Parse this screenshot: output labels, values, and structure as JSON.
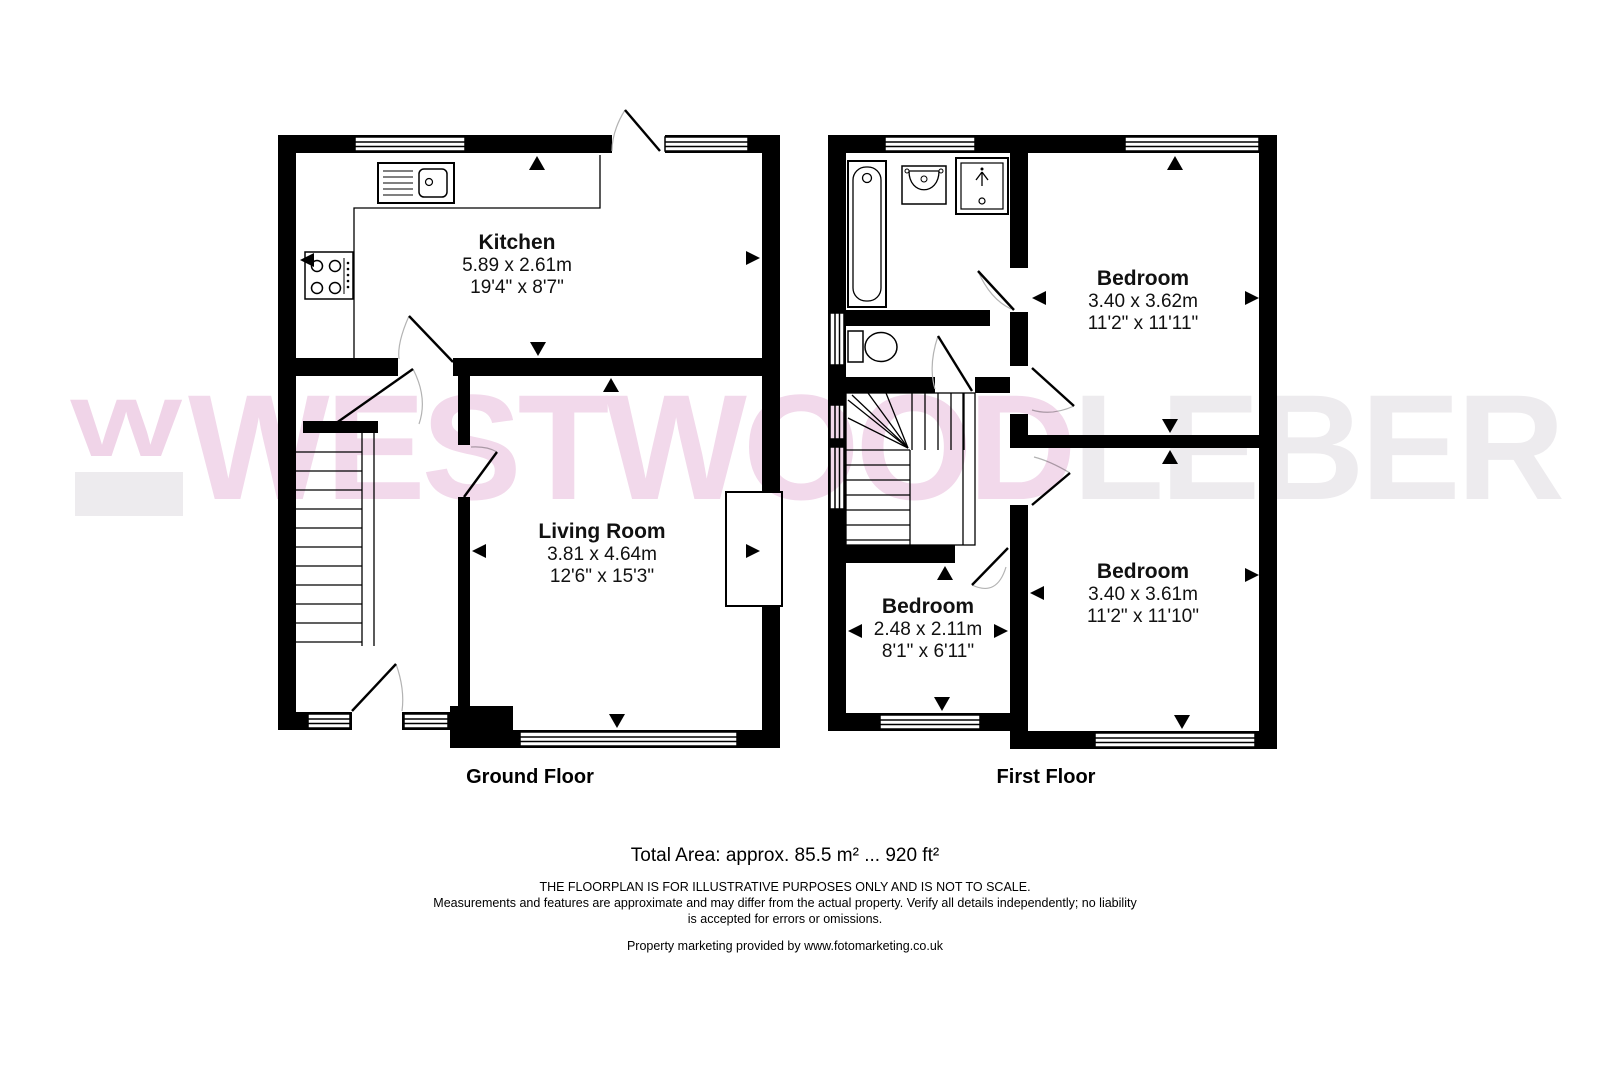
{
  "brand": {
    "logo_letter": "W",
    "name_primary": "WESTWOOD",
    "name_secondary": "LEBER",
    "pink": "#f2d9eb",
    "gray": "#edebee"
  },
  "floors": {
    "ground": {
      "label": "Ground Floor",
      "rooms": {
        "kitchen": {
          "name": "Kitchen",
          "metric": "5.89 x 2.61m",
          "imperial": "19'4\" x 8'7\""
        },
        "living": {
          "name": "Living Room",
          "metric": "3.81 x 4.64m",
          "imperial": "12'6\" x 15'3\""
        }
      }
    },
    "first": {
      "label": "First Floor",
      "rooms": {
        "bedroom_top": {
          "name": "Bedroom",
          "metric": "3.40 x 3.62m",
          "imperial": "11'2\" x 11'11\""
        },
        "bedroom_small": {
          "name": "Bedroom",
          "metric": "2.48 x 2.11m",
          "imperial": "8'1\" x 6'11\""
        },
        "bedroom_bottom": {
          "name": "Bedroom",
          "metric": "3.40 x 3.61m",
          "imperial": "11'2\" x 11'10\""
        }
      }
    }
  },
  "footer": {
    "total_area": "Total Area: approx. 85.5 m² ... 920 ft²",
    "disclaimer_line1": "THE FLOORPLAN IS FOR ILLUSTRATIVE PURPOSES ONLY AND IS NOT TO SCALE.",
    "disclaimer_line2": "Measurements and features are approximate and may differ from the actual property. Verify all details independently; no liability",
    "disclaimer_line3": "is accepted for errors or omissions.",
    "credit": "Property marketing provided by www.fotomarketing.co.uk"
  }
}
